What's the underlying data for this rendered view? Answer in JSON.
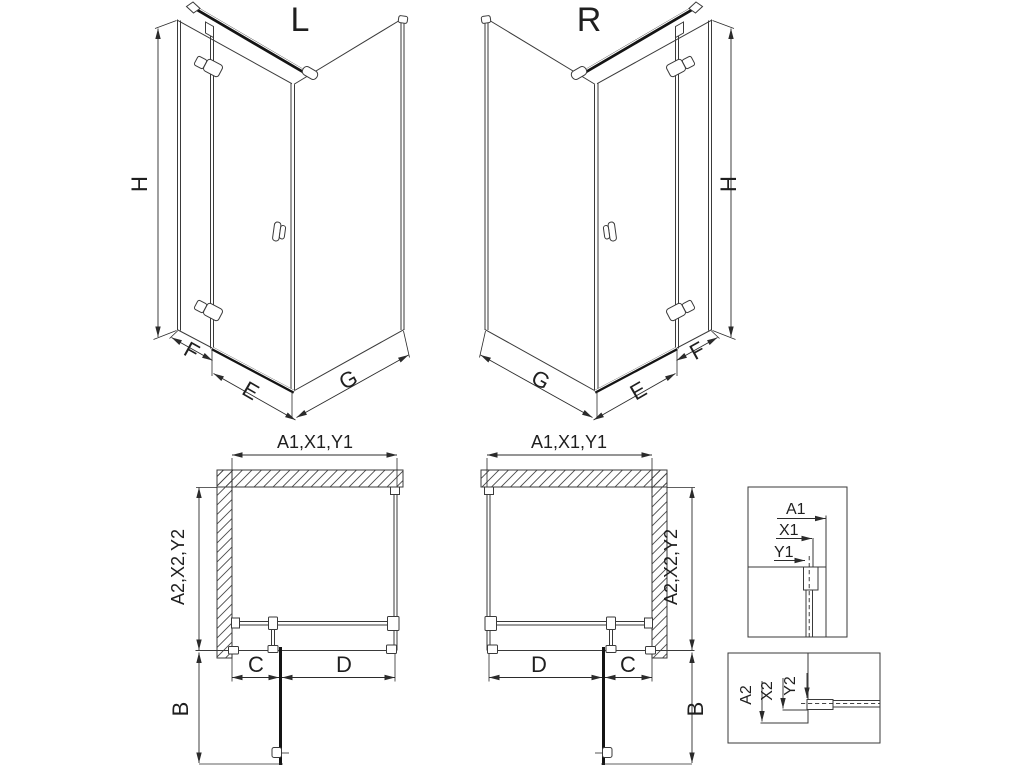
{
  "page": {
    "type": "technical-dimension-drawing",
    "subject": "corner shower enclosure left/right variants with plan views and profile details",
    "background": "#ffffff"
  },
  "colors": {
    "line": "#3a3a3a",
    "dark": "#141414",
    "dimension": "#2b2b2b",
    "text": "#1f1f1f",
    "hatch": "#4a4a4a",
    "bg": "#ffffff"
  },
  "views": {
    "iso_left": {
      "title": "L",
      "dims": {
        "height": "H",
        "fixed": "F",
        "door": "E",
        "side": "G"
      }
    },
    "iso_right": {
      "title": "R",
      "dims": {
        "height": "H",
        "fixed": "F",
        "door": "E",
        "side": "G"
      }
    },
    "plan_left": {
      "dims": {
        "top": "A1,X1,Y1",
        "side": "A2,X2,Y2",
        "c": "C",
        "d": "D",
        "b": "B"
      }
    },
    "plan_right": {
      "dims": {
        "top": "A1,X1,Y1",
        "side": "A2,X2,Y2",
        "c": "C",
        "d": "D",
        "b": "B"
      }
    },
    "detail_top": {
      "dims": {
        "a1": "A1",
        "x1": "X1",
        "y1": "Y1"
      }
    },
    "detail_bottom": {
      "dims": {
        "a2": "A2",
        "x2": "X2",
        "y2": "Y2"
      }
    }
  }
}
